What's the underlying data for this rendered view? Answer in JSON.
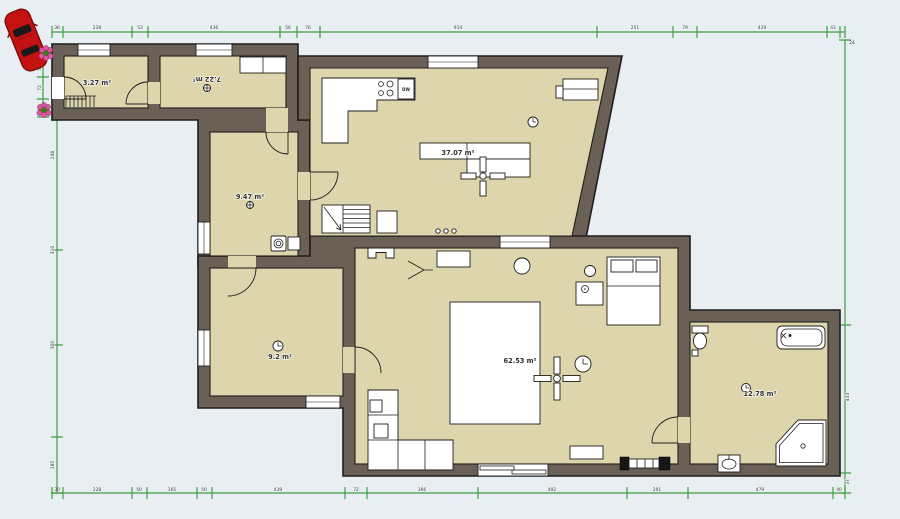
{
  "palette": {
    "background": "#e8eef1",
    "wall": "#6a6055",
    "outline": "#1e1e1e",
    "floor": "#ddd5ab",
    "dimension_green": "#3f9e43",
    "furniture_white": "#ffffff",
    "car_red": "#c41111",
    "flower_pink": "#d9589e"
  },
  "rooms": [
    {
      "name": "entry",
      "area": "3.27 m²"
    },
    {
      "name": "hallway",
      "area": "7.22 m²"
    },
    {
      "name": "hall",
      "area": "9.47 m²"
    },
    {
      "name": "kitchen-living",
      "area": "37.07 m²"
    },
    {
      "name": "middle-room",
      "area": "9.2 m²"
    },
    {
      "name": "main-room",
      "area": "62.53 m²"
    },
    {
      "name": "bathroom",
      "area": "12.78 m²"
    }
  ],
  "labels": {
    "dishwasher": "DW"
  },
  "dimensions": {
    "top": [
      "36",
      "228",
      "53",
      "436",
      "56",
      "76",
      "914",
      "251",
      "79",
      "429",
      "43"
    ],
    "top_corner": "24",
    "bottom": [
      "30",
      "228",
      "50",
      "165",
      "50",
      "439",
      "72",
      "366",
      "492",
      "201",
      "479",
      "40"
    ],
    "left_outer": [
      "248",
      "310",
      "300",
      "185"
    ],
    "left_inner": [
      "56",
      "72",
      "60"
    ],
    "right": [
      "433",
      "37"
    ]
  }
}
